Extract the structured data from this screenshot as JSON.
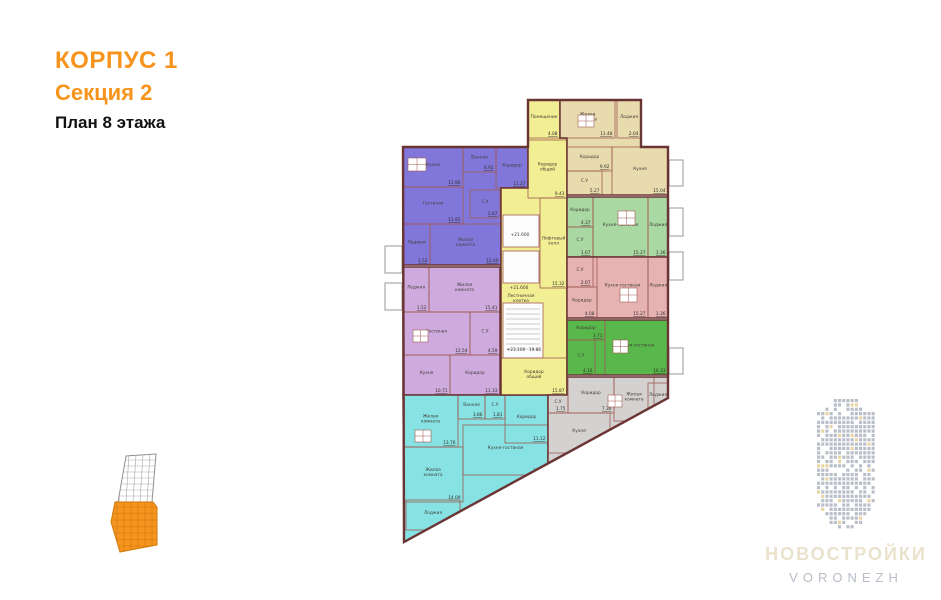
{
  "header": {
    "building": "КОРПУС 1",
    "section": "Секция 2",
    "floor": "План 8 этажа",
    "accent_color": "#f7941d"
  },
  "logo": {
    "title": "НОВОСТРОЙКИ",
    "subtitle": "VORONEZH",
    "title_color": "#e9e2cc",
    "subtitle_color": "#b8bdc7",
    "building_color": "#b9bec9",
    "building_accent": "#e8d5a2"
  },
  "minimap": {
    "section_color": "#f5941e",
    "section_line_color": "#d0790a",
    "outline_color": "#909090",
    "grid_color": "#aaaaaa"
  },
  "plan": {
    "wall_color": "#6b3434",
    "partition_color": "#a05a52",
    "background": "#ffffff",
    "envelope": [
      [
        403,
        147
      ],
      [
        528,
        147
      ],
      [
        528,
        100
      ],
      [
        641,
        100
      ],
      [
        641,
        147
      ],
      [
        668,
        147
      ],
      [
        668,
        398
      ],
      [
        404,
        542
      ]
    ],
    "balconies": [
      [
        385,
        246,
        17,
        27
      ],
      [
        385,
        283,
        17,
        27
      ],
      [
        669,
        160,
        14,
        26
      ],
      [
        669,
        208,
        14,
        28
      ],
      [
        669,
        252,
        14,
        28
      ],
      [
        669,
        348,
        14,
        26
      ]
    ],
    "marks": [
      {
        "text": "+21.600",
        "x": 520,
        "y": 236
      },
      {
        "text": "+21.600",
        "x": 519,
        "y": 289
      },
      {
        "text": "Лестничная клетка",
        "x": 521,
        "y": 297
      },
      {
        "text": "+23.100",
        "x": 516,
        "y": 351
      },
      {
        "text": "19.86",
        "x": 535,
        "y": 351
      }
    ],
    "apartments": [
      {
        "id": "purple",
        "color": "#8177db",
        "outline": [
          [
            403,
            147
          ],
          [
            528,
            147
          ],
          [
            528,
            188
          ],
          [
            501,
            188
          ],
          [
            501,
            265
          ],
          [
            403,
            265
          ]
        ],
        "icons": [
          [
            408,
            158,
            18,
            13
          ]
        ],
        "rooms": [
          {
            "name": "Кухня",
            "area": "11.90",
            "x": 403,
            "y": 147,
            "w": 60,
            "h": 40
          },
          {
            "name": "Ванная",
            "area": "4.92",
            "x": 463,
            "y": 147,
            "w": 33,
            "h": 25
          },
          {
            "name": "Коридор",
            "area": "11.27",
            "x": 496,
            "y": 147,
            "w": 32,
            "h": 41
          },
          {
            "name": "Гостиная",
            "area": "11.95",
            "x": 403,
            "y": 187,
            "w": 60,
            "h": 37
          },
          {
            "name": "С.У",
            "area": "2.87",
            "x": 470,
            "y": 190,
            "w": 30,
            "h": 28
          },
          {
            "name": "Жилая комната",
            "area": "15.40",
            "x": 430,
            "y": 224,
            "w": 71,
            "h": 41
          },
          {
            "name": "Лоджия",
            "area": "1.52",
            "x": 403,
            "y": 224,
            "w": 27,
            "h": 41
          }
        ]
      },
      {
        "id": "lavender",
        "color": "#cfaade",
        "outline": [
          [
            403,
            267
          ],
          [
            500,
            267
          ],
          [
            500,
            395
          ],
          [
            403,
            395
          ]
        ],
        "icons": [
          [
            413,
            330,
            15,
            12
          ]
        ],
        "rooms": [
          {
            "name": "Лоджия",
            "area": "1.52",
            "x": 403,
            "y": 267,
            "w": 26,
            "h": 45
          },
          {
            "name": "Жилая комната",
            "area": "15.41",
            "x": 429,
            "y": 267,
            "w": 71,
            "h": 45
          },
          {
            "name": "Гостиная",
            "area": "12.54",
            "x": 403,
            "y": 312,
            "w": 67,
            "h": 43
          },
          {
            "name": "С.У",
            "area": "4.59",
            "x": 470,
            "y": 312,
            "w": 30,
            "h": 43
          },
          {
            "name": "Кухня",
            "area": "10.71",
            "x": 403,
            "y": 355,
            "w": 47,
            "h": 40
          },
          {
            "name": "Коридор",
            "area": "11.33",
            "x": 450,
            "y": 355,
            "w": 50,
            "h": 40
          }
        ]
      },
      {
        "id": "cyan",
        "color": "#86e2e3",
        "outline": [
          [
            403,
            395
          ],
          [
            548,
            395
          ],
          [
            548,
            463
          ],
          [
            404,
            542
          ]
        ],
        "icons": [
          [
            415,
            430,
            16,
            12
          ]
        ],
        "rooms": [
          {
            "name": "Жилая комната",
            "area": "13.76",
            "x": 403,
            "y": 395,
            "w": 55,
            "h": 52
          },
          {
            "name": "Ванная",
            "area": "3.86",
            "x": 458,
            "y": 395,
            "w": 27,
            "h": 24
          },
          {
            "name": "С.У",
            "area": "1.81",
            "x": 485,
            "y": 395,
            "w": 20,
            "h": 24
          },
          {
            "name": "Коридор",
            "area": "11.12",
            "x": 505,
            "y": 395,
            "w": 43,
            "h": 48
          },
          {
            "name": "Жилая комната",
            "area": "14.09",
            "x": 403,
            "y": 447,
            "w": 60,
            "h": 55
          },
          {
            "name": "Кухня-гостиная",
            "area": "25.46",
            "x": 463,
            "y": 425,
            "w": 85,
            "h": 50
          },
          {
            "name": "Лоджия",
            "area": "8.25",
            "x": 406,
            "y": 500,
            "w": 54,
            "h": 30
          }
        ]
      },
      {
        "id": "core",
        "color": "#f2ee93",
        "outline": [
          [
            528,
            100
          ],
          [
            560,
            100
          ],
          [
            560,
            138
          ],
          [
            567,
            138
          ],
          [
            567,
            395
          ],
          [
            501,
            395
          ],
          [
            501,
            188
          ],
          [
            528,
            188
          ]
        ],
        "rooms": [
          {
            "name": "Помещение",
            "area": "4.08",
            "x": 528,
            "y": 100,
            "w": 32,
            "h": 38
          },
          {
            "name": "Коридор общий",
            "area": "9.43",
            "x": 528,
            "y": 140,
            "w": 39,
            "h": 58
          },
          {
            "name": "Лифтовый холл",
            "area": "15.32",
            "x": 540,
            "y": 198,
            "w": 27,
            "h": 90
          },
          {
            "name": "",
            "x": 503,
            "y": 215,
            "w": 36,
            "h": 32,
            "fill": "#fdfdfd"
          },
          {
            "name": "",
            "x": 503,
            "y": 251,
            "w": 36,
            "h": 32,
            "fill": "#fdfdfd"
          },
          {
            "name": "",
            "x": 503,
            "y": 303,
            "w": 40,
            "h": 55,
            "fill": "#fdfdfd",
            "type": "stairs"
          },
          {
            "name": "Коридор общий",
            "area": "15.87",
            "x": 501,
            "y": 358,
            "w": 66,
            "h": 37
          }
        ]
      },
      {
        "id": "beige",
        "color": "#e8dcae",
        "outline": [
          [
            560,
            100
          ],
          [
            641,
            100
          ],
          [
            641,
            147
          ],
          [
            668,
            147
          ],
          [
            668,
            195
          ],
          [
            567,
            195
          ],
          [
            567,
            138
          ],
          [
            560,
            138
          ]
        ],
        "icons": [
          [
            578,
            115,
            16,
            12
          ]
        ],
        "rooms": [
          {
            "name": "Жилая комната",
            "area": "11.48",
            "x": 560,
            "y": 100,
            "w": 55,
            "h": 38
          },
          {
            "name": "Лоджия",
            "area": "2.04",
            "x": 617,
            "y": 100,
            "w": 24,
            "h": 38
          },
          {
            "name": "Коридор",
            "area": "9.92",
            "x": 567,
            "y": 147,
            "w": 45,
            "h": 24
          },
          {
            "name": "С.У",
            "area": "5.27",
            "x": 567,
            "y": 171,
            "w": 35,
            "h": 24
          },
          {
            "name": "Кухня",
            "area": "15.04",
            "x": 612,
            "y": 147,
            "w": 56,
            "h": 48
          }
        ]
      },
      {
        "id": "light-green",
        "color": "#a9d8a3",
        "outline": [
          [
            567,
            197
          ],
          [
            668,
            197
          ],
          [
            668,
            257
          ],
          [
            567,
            257
          ]
        ],
        "icons": [
          [
            618,
            211,
            17,
            14
          ]
        ],
        "rooms": [
          {
            "name": "Коридор",
            "area": "4.37",
            "x": 567,
            "y": 197,
            "w": 26,
            "h": 30
          },
          {
            "name": "С.У",
            "area": "1.67",
            "x": 567,
            "y": 227,
            "w": 26,
            "h": 30
          },
          {
            "name": "Кухня-гостиная",
            "area": "15.27",
            "x": 593,
            "y": 197,
            "w": 55,
            "h": 60
          },
          {
            "name": "Лоджия",
            "area": "1.36",
            "x": 648,
            "y": 197,
            "w": 20,
            "h": 60
          }
        ]
      },
      {
        "id": "pink",
        "color": "#e6b2b2",
        "outline": [
          [
            567,
            257
          ],
          [
            668,
            257
          ],
          [
            668,
            318
          ],
          [
            567,
            318
          ]
        ],
        "icons": [
          [
            620,
            288,
            17,
            14
          ]
        ],
        "rooms": [
          {
            "name": "С.У",
            "area": "2.67",
            "x": 567,
            "y": 257,
            "w": 26,
            "h": 30
          },
          {
            "name": "Коридор",
            "area": "4.08",
            "x": 567,
            "y": 287,
            "w": 30,
            "h": 31
          },
          {
            "name": "Кухня-гостиная",
            "area": "15.27",
            "x": 597,
            "y": 257,
            "w": 51,
            "h": 61
          },
          {
            "name": "Лоджия",
            "area": "1.36",
            "x": 648,
            "y": 257,
            "w": 20,
            "h": 61
          }
        ]
      },
      {
        "id": "green",
        "color": "#58b84b",
        "outline": [
          [
            567,
            320
          ],
          [
            668,
            320
          ],
          [
            668,
            375
          ],
          [
            567,
            375
          ]
        ],
        "icons": [
          [
            613,
            340,
            15,
            13
          ]
        ],
        "rooms": [
          {
            "name": "Коридор",
            "area": "3.71",
            "x": 567,
            "y": 320,
            "w": 38,
            "h": 20
          },
          {
            "name": "С.У",
            "area": "4.10",
            "x": 567,
            "y": 340,
            "w": 28,
            "h": 35
          },
          {
            "name": "Кухня-гостиная",
            "area": "16.33",
            "x": 605,
            "y": 320,
            "w": 63,
            "h": 55
          }
        ]
      },
      {
        "id": "gray",
        "color": "#d3d2d0",
        "outline": [
          [
            567,
            377
          ],
          [
            668,
            377
          ],
          [
            668,
            398
          ],
          [
            548,
            463
          ],
          [
            548,
            395
          ],
          [
            567,
            395
          ]
        ],
        "icons": [
          [
            608,
            395,
            14,
            12
          ]
        ],
        "rooms": [
          {
            "name": "С.У",
            "area": "1.75",
            "x": 548,
            "y": 395,
            "w": 20,
            "h": 18
          },
          {
            "name": "Коридор",
            "area": "7.36",
            "x": 568,
            "y": 377,
            "w": 46,
            "h": 36
          },
          {
            "name": "Жилая комната",
            "area": "13.05",
            "x": 614,
            "y": 377,
            "w": 40,
            "h": 44
          },
          {
            "name": "Лоджия",
            "area": "1.58",
            "x": 648,
            "y": 383,
            "w": 20,
            "h": 28
          },
          {
            "name": "Кухня",
            "area": "13.06",
            "x": 548,
            "y": 413,
            "w": 62,
            "h": 40
          }
        ]
      }
    ]
  }
}
